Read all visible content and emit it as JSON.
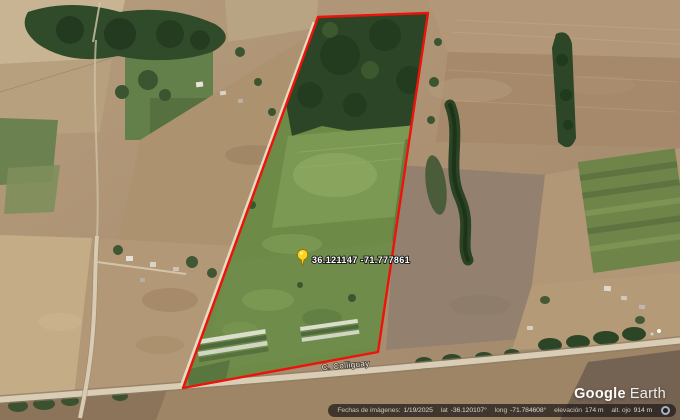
{
  "map": {
    "placemark": {
      "label": "36.121147  -71.777861",
      "pin_color": "#ffd41f"
    },
    "boundary_color": "#ee1209",
    "road_label": "C. Colliguay"
  },
  "watermark": {
    "google": "Google",
    "earth": "Earth"
  },
  "status_bar": {
    "imagery_label": "Fechas de imágenes:",
    "imagery_date": "1/19/2025",
    "lat_label": "lat",
    "lat_value": "-36.120107°",
    "long_label": "long",
    "long_value": "-71.784608°",
    "elevation_label": "elevación",
    "elevation_value": "174 m",
    "eye_alt_label": "alt. ojo",
    "eye_alt_value": "914 m"
  }
}
